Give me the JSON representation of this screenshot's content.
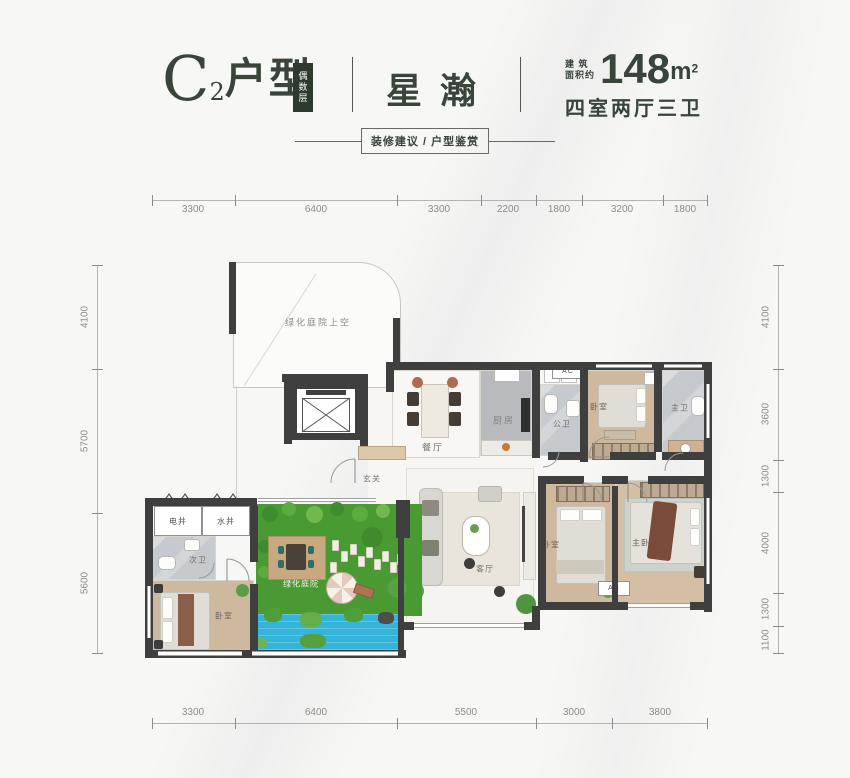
{
  "header": {
    "unit_letter": "C",
    "unit_sub": "2",
    "unit_suffix": "户型",
    "badge_vertical": "偶数层",
    "name": "星瀚",
    "area_prefix_line1": "建 筑",
    "area_prefix_line2": "面积约",
    "area_value": "148",
    "area_unit": "m",
    "area_unit_sup": "2",
    "layout_desc": "四室两厅三卫",
    "ribbon": "装修建议 / 户型鉴赏"
  },
  "dimensions": {
    "top": [
      "3300",
      "6400",
      "3300",
      "2200",
      "1800",
      "3200",
      "1800"
    ],
    "bottom": [
      "3300",
      "6400",
      "5500",
      "3000",
      "3800"
    ],
    "left": [
      "4100",
      "5700",
      "5600"
    ],
    "right": [
      "4100",
      "3600",
      "1300",
      "4000",
      "1300",
      "1100"
    ]
  },
  "rooms": {
    "void_label": "绿化庭院上空",
    "dining": "餐厅",
    "kitchen": "厨房",
    "public_bath": "公卫",
    "bedroom_top": "卧室",
    "master_bath": "主卫",
    "foyer": "玄关",
    "living": "客厅",
    "bedroom_mid": "卧室",
    "master_bedroom": "主卧",
    "electric_shaft": "电井",
    "water_shaft": "水井",
    "second_bath": "次卫",
    "bedroom_bottom": "卧室",
    "courtyard": "绿化庭院",
    "ac": "AC"
  },
  "colors": {
    "title_text": "#39443a",
    "badge_bg": "#2e3a2e",
    "wall": "#3f3f3f",
    "wood_floor": "#cfb99e",
    "tile_floor": "#c6c9cd",
    "grass": "#4a9a33",
    "pool": "#35b4da"
  }
}
